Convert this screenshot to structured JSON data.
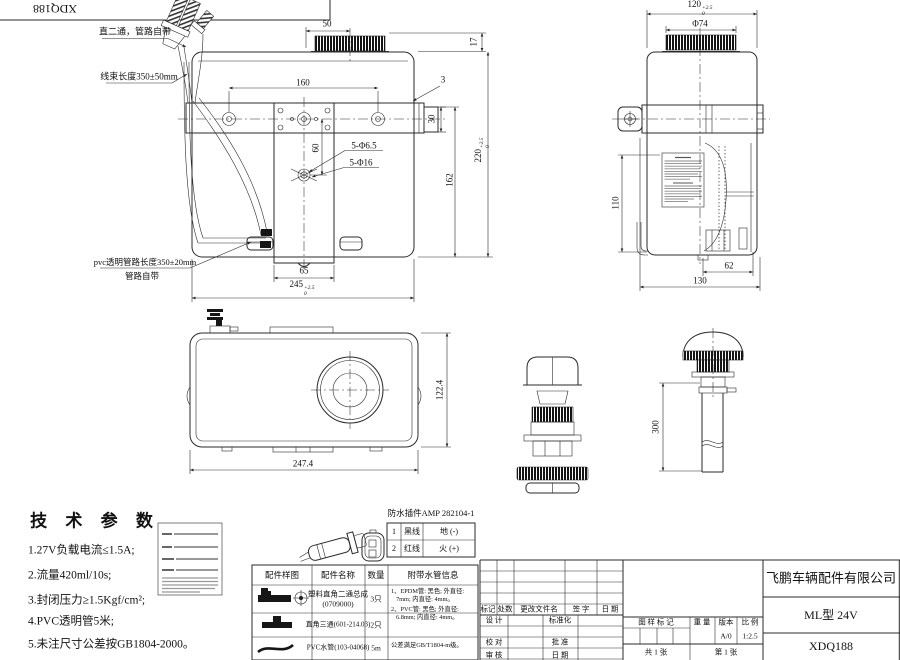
{
  "frame": {
    "ref": "XDQ188"
  },
  "front_view": {
    "notes": {
      "fitting": "直二通，管路自带",
      "harness": "线束长度350±50mm",
      "pvc_line1": "pvc透明管路长度350±20mm",
      "pvc_line2": "管路自带"
    },
    "dims": {
      "d50": "50",
      "d17": "17",
      "d160": "160",
      "d3": "3",
      "d30": "30",
      "d60": "60",
      "holes_small": "5-Φ6.5",
      "holes_large": "5-Φ16",
      "d220": "220",
      "d220_sup": "+2.5",
      "d220_sub": "0",
      "d162": "162",
      "d65": "65",
      "d245": "245",
      "d245_sup": "+2.5",
      "d245_sub": "0"
    }
  },
  "side_view": {
    "dims": {
      "d120": "120",
      "d120_sup": "+2.5",
      "d120_sub": "0",
      "dia": "Φ74",
      "d110": "110",
      "d62": "62",
      "d130": "130"
    }
  },
  "top_view": {
    "dims": {
      "d122": "122.4",
      "d247": "247.4"
    }
  },
  "filler_tube": {
    "dims": {
      "d300": "300"
    }
  },
  "tech_specs": {
    "title": "技 术 参 数",
    "items": [
      "1.27V负载电流≤1.5A;",
      "2.流量420ml/10s;",
      "3.封闭压力≥1.5Kgf/cm²;",
      "4.PVC透明管5米;",
      "5.未注尺寸公差按GB1804-2000。"
    ]
  },
  "wiring": {
    "title": "防水插件AMP 282104-1",
    "rows": [
      {
        "num": "1",
        "wire": "黑线",
        "polarity": "地 (-)"
      },
      {
        "num": "2",
        "wire": "红线",
        "polarity": "火 (+)"
      }
    ]
  },
  "parts_table": {
    "headers": [
      "配件样图",
      "配件名称",
      "数量",
      "附带水管信息"
    ],
    "rows": [
      {
        "name": "塑料直角二通总成",
        "name2": "(0709000)",
        "qty": "3只"
      },
      {
        "name": "直角三通(601-214.03)",
        "qty": "2只"
      },
      {
        "name": "PVC水管(103-04068)",
        "qty": "5m"
      }
    ],
    "hose_info": [
      "1、EPDM管: 黑色; 外直径:",
      "7mm; 内直径: 4mm。",
      "2、PVC管: 黑色; 外直径:",
      "6.8mm; 内直径: 4mm。",
      "公差满足GB/T1804-m级。"
    ]
  },
  "title_block": {
    "company": "飞鹏车辆配件有限公司",
    "model": "ML型 24V",
    "code": "XDQ188",
    "rev": {
      "mark": "标记",
      "count": "处数",
      "file": "更改文件名",
      "sign": "签 字",
      "date": "日 期"
    },
    "roles": {
      "design": "设 计",
      "standardize": "标准化",
      "check": "校 对",
      "approve": "批 准",
      "audit": "审 核",
      "date": "日 期"
    },
    "mark_header": "图 样 标 记",
    "weight": "重 量",
    "version_label": "版本",
    "scale_label": "比 例",
    "version": "A/0",
    "scale": "1:2.5",
    "sheet_total": "共 1 张",
    "sheet_no": "第 1 张"
  }
}
